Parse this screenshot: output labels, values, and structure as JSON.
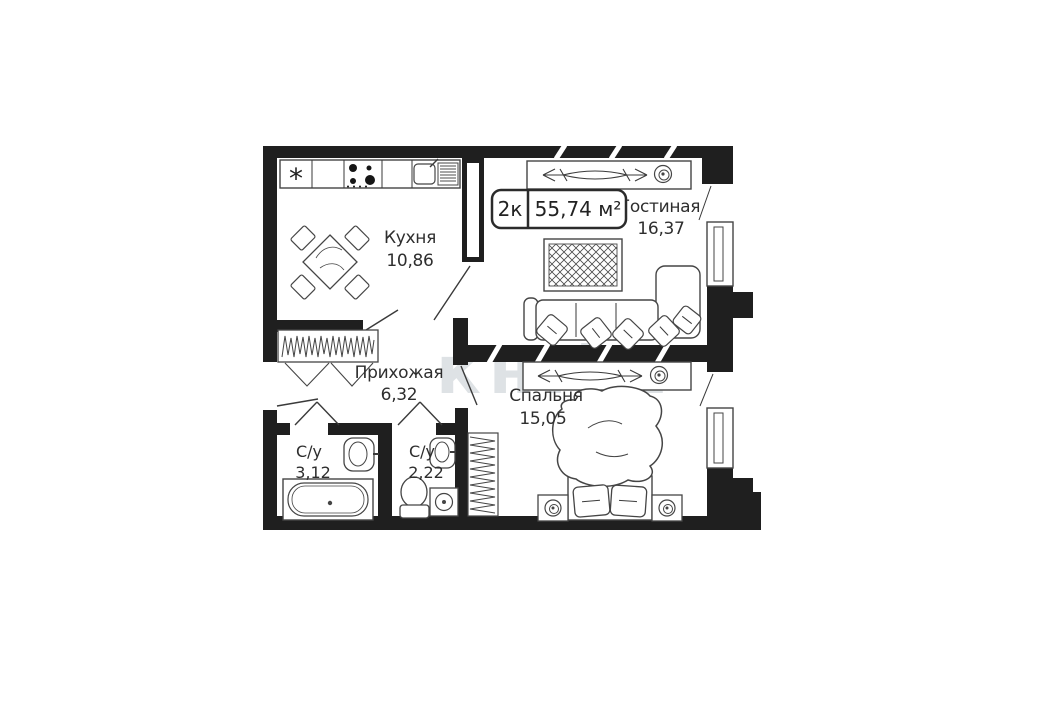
{
  "plan": {
    "badge": {
      "rooms": "2к",
      "area": "55,74 м²"
    },
    "rooms": {
      "kitchen": {
        "name": "Кухня",
        "area": "10,86"
      },
      "living": {
        "name": "Гостиная",
        "area": "16,37"
      },
      "hallway": {
        "name": "Прихожая",
        "area": "6,32"
      },
      "bedroom": {
        "name": "Спальня",
        "area": "15,05"
      },
      "bath1": {
        "name": "С/у",
        "area": "3,12"
      },
      "bath2": {
        "name": "С/у",
        "area": "2,22"
      }
    },
    "icons": {
      "fridge_symbol": "*"
    },
    "watermark": "кн.kz",
    "colors": {
      "wall": "#1f1f1f",
      "furniture_line": "#454545",
      "label_text": "#2e2e2e",
      "watermark": "#d7dcdf"
    }
  }
}
